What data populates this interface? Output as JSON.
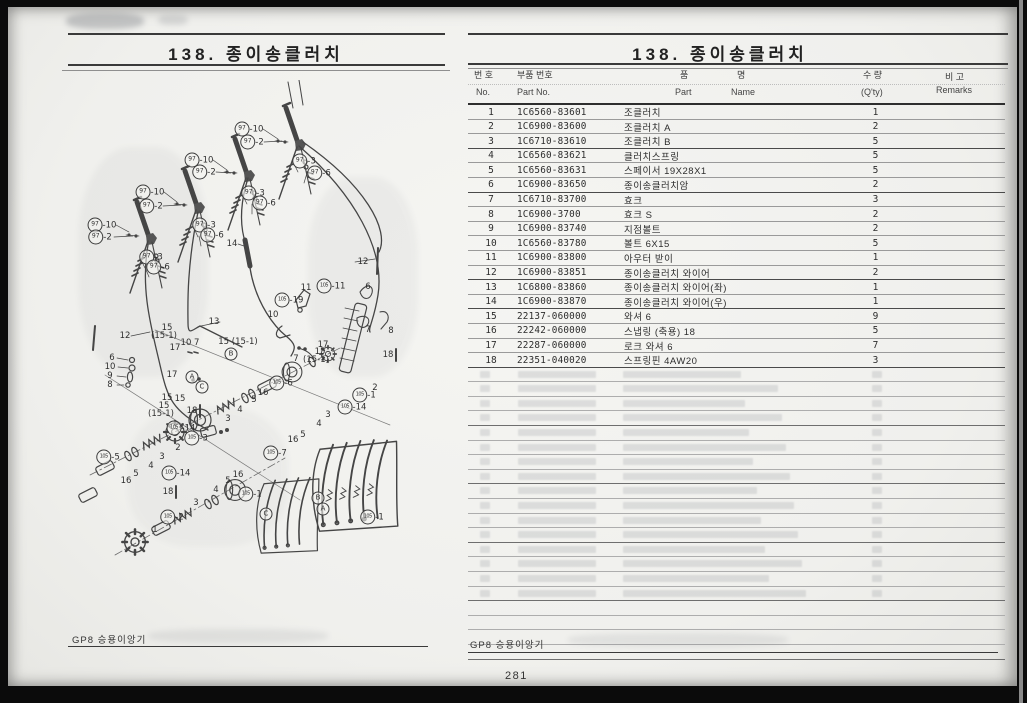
{
  "meta": {
    "ink_color": "#3f3f3f",
    "paper_color": "#f1f1ee",
    "frame_color": "#0b0b0b"
  },
  "page_number": "281",
  "left_page": {
    "title": "138.  종이송클러치",
    "footer": "GP8 승용이앙기"
  },
  "right_page": {
    "title": "138.  종이송클러치",
    "footer": "GP8 승용이앙기",
    "table": {
      "headers": {
        "no_ko": "번 호",
        "no_en": "No.",
        "part_ko": "부품 번호",
        "part_en": "Part  No.",
        "name_ko_1": "품",
        "name_ko_2": "명",
        "name_en_1": "Part",
        "name_en_2": "Name",
        "qty_ko": "수 량",
        "qty_en": "(Q'ty)",
        "remarks_ko": "비 고",
        "remarks_en": "Remarks"
      },
      "rows": [
        {
          "no": "1",
          "part": "1C6560-83601",
          "name": "조클러치",
          "qty": "1",
          "remarks": ""
        },
        {
          "no": "2",
          "part": "1C6900-83600",
          "name": "조클러치 A",
          "qty": "2",
          "remarks": ""
        },
        {
          "no": "3",
          "part": "1C6710-83610",
          "name": "조클러치 B",
          "qty": "5",
          "remarks": ""
        },
        {
          "no": "4",
          "part": "1C6560-83621",
          "name": "클러치스프링",
          "qty": "5",
          "remarks": ""
        },
        {
          "no": "5",
          "part": "1C6560-83631",
          "name": "스페이서 19X28X1",
          "qty": "5",
          "remarks": ""
        },
        {
          "no": "6",
          "part": "1C6900-83650",
          "name": "종이송클러치암",
          "qty": "2",
          "remarks": ""
        },
        {
          "no": "7",
          "part": "1C6710-83700",
          "name": "효크",
          "qty": "3",
          "remarks": ""
        },
        {
          "no": "8",
          "part": "1C6900-3700",
          "name": "효크 S",
          "qty": "2",
          "remarks": ""
        },
        {
          "no": "9",
          "part": "1C6900-83740",
          "name": "지점볼트",
          "qty": "2",
          "remarks": ""
        },
        {
          "no": "10",
          "part": "1C6560-83780",
          "name": "볼트 6X15",
          "qty": "5",
          "remarks": ""
        },
        {
          "no": "11",
          "part": "1C6900-83800",
          "name": "아우터 받이",
          "qty": "1",
          "remarks": ""
        },
        {
          "no": "12",
          "part": "1C6900-83851",
          "name": "종이송클러치 와이어",
          "qty": "2",
          "remarks": ""
        },
        {
          "no": "13",
          "part": "1C6800-83860",
          "name": "종이송클러치 와이어(좌)",
          "qty": "1",
          "remarks": ""
        },
        {
          "no": "14",
          "part": "1C6900-83870",
          "name": "종이송클러치 와이어(우)",
          "qty": "1",
          "remarks": ""
        },
        {
          "no": "15",
          "part": "22137-060000",
          "name": "와셔 6",
          "qty": "9",
          "remarks": ""
        },
        {
          "no": "16",
          "part": "22242-060000",
          "name": "스냅링 (축용) 18",
          "qty": "5",
          "remarks": ""
        },
        {
          "no": "17",
          "part": "22287-060000",
          "name": "로크 와셔 6",
          "qty": "7",
          "remarks": ""
        },
        {
          "no": "18",
          "part": "22351-040020",
          "name": "스프링핀 4AW20",
          "qty": "3",
          "remarks": ""
        }
      ],
      "heavy_after_rows": [
        3,
        6,
        12,
        14,
        18
      ],
      "empty_row_count": 20
    }
  },
  "diagram": {
    "callouts": [
      {
        "t": "97",
        "s": "-10",
        "x": 42,
        "y": 145
      },
      {
        "t": "97",
        "s": "-2",
        "x": 40,
        "y": 157
      },
      {
        "t": "97",
        "s": "-3",
        "x": 91,
        "y": 177
      },
      {
        "t": "97",
        "s": "-6",
        "x": 98,
        "y": 187
      },
      {
        "t": "97",
        "s": "-10",
        "x": 90,
        "y": 112
      },
      {
        "t": "97",
        "s": "-2",
        "x": 91,
        "y": 126
      },
      {
        "t": "97",
        "s": "-3",
        "x": 144,
        "y": 145
      },
      {
        "t": "97",
        "s": "-6",
        "x": 152,
        "y": 155
      },
      {
        "t": "97",
        "s": "-10",
        "x": 139,
        "y": 80
      },
      {
        "t": "97",
        "s": "-2",
        "x": 144,
        "y": 92
      },
      {
        "t": "97",
        "s": "-3",
        "x": 193,
        "y": 113
      },
      {
        "t": "97",
        "s": "-6",
        "x": 204,
        "y": 123
      },
      {
        "t": "97",
        "s": "-10",
        "x": 189,
        "y": 49
      },
      {
        "t": "97",
        "s": "-2",
        "x": 192,
        "y": 62
      },
      {
        "t": "97",
        "s": "-3",
        "x": 244,
        "y": 81
      },
      {
        "t": "97",
        "s": "-6",
        "x": 259,
        "y": 93
      },
      {
        "t": "p",
        "s": "14",
        "x": 172,
        "y": 164
      },
      {
        "t": "p",
        "s": "12",
        "x": 303,
        "y": 182
      },
      {
        "t": "p",
        "s": "13",
        "x": 154,
        "y": 242
      },
      {
        "t": "p",
        "s": "12",
        "x": 65,
        "y": 256
      },
      {
        "t": "p",
        "s": "15",
        "x": 107,
        "y": 248
      },
      {
        "t": "p",
        "s": "(15-1)",
        "x": 104,
        "y": 256
      },
      {
        "t": "p",
        "s": "6",
        "x": 52,
        "y": 278
      },
      {
        "t": "p",
        "s": "10",
        "x": 50,
        "y": 287
      },
      {
        "t": "p",
        "s": "9",
        "x": 50,
        "y": 296
      },
      {
        "t": "p",
        "s": "8",
        "x": 50,
        "y": 305
      },
      {
        "t": "p",
        "s": "17",
        "x": 115,
        "y": 268
      },
      {
        "t": "p",
        "s": "10 7",
        "x": 130,
        "y": 263
      },
      {
        "t": "p",
        "s": "15 (15-1)",
        "x": 178,
        "y": 262
      },
      {
        "t": "L",
        "s": "B",
        "x": 171,
        "y": 274
      },
      {
        "t": "p",
        "s": "17",
        "x": 112,
        "y": 295
      },
      {
        "t": "L",
        "s": "A",
        "x": 132,
        "y": 297
      },
      {
        "t": "L",
        "s": "C",
        "x": 142,
        "y": 307
      },
      {
        "t": "p",
        "s": "15",
        "x": 107,
        "y": 318
      },
      {
        "t": "p",
        "s": "15",
        "x": 120,
        "y": 319
      },
      {
        "t": "p",
        "s": "15",
        "x": 104,
        "y": 326
      },
      {
        "t": "p",
        "s": "(15-1)",
        "x": 101,
        "y": 334
      },
      {
        "t": "p",
        "s": "18",
        "x": 132,
        "y": 331
      },
      {
        "t": "p",
        "s": "2",
        "x": 118,
        "y": 368
      },
      {
        "t": "p",
        "s": "3",
        "x": 102,
        "y": 377
      },
      {
        "t": "p",
        "s": "4",
        "x": 91,
        "y": 386
      },
      {
        "t": "p",
        "s": "5",
        "x": 76,
        "y": 394
      },
      {
        "t": "p",
        "s": "16",
        "x": 66,
        "y": 401
      },
      {
        "t": "105",
        "s": "-5",
        "x": 48,
        "y": 377
      },
      {
        "t": "105",
        "s": "-14",
        "x": 121,
        "y": 348
      },
      {
        "t": "105",
        "s": "-3",
        "x": 136,
        "y": 358
      },
      {
        "t": "p",
        "s": "18",
        "x": 108,
        "y": 412
      },
      {
        "t": "p",
        "s": "1",
        "x": 95,
        "y": 450
      },
      {
        "t": "105",
        "s": "-2",
        "x": 112,
        "y": 437
      },
      {
        "t": "105",
        "s": "-14",
        "x": 116,
        "y": 393
      },
      {
        "t": "p",
        "s": "3",
        "x": 136,
        "y": 423
      },
      {
        "t": "p",
        "s": "4",
        "x": 156,
        "y": 410
      },
      {
        "t": "p",
        "s": "5",
        "x": 168,
        "y": 401
      },
      {
        "t": "p",
        "s": "16",
        "x": 178,
        "y": 395
      },
      {
        "t": "p",
        "s": "16",
        "x": 203,
        "y": 313
      },
      {
        "t": "p",
        "s": "5",
        "x": 194,
        "y": 320
      },
      {
        "t": "p",
        "s": "4",
        "x": 180,
        "y": 330
      },
      {
        "t": "p",
        "s": "3",
        "x": 168,
        "y": 339
      },
      {
        "t": "105",
        "s": "-6",
        "x": 221,
        "y": 303
      },
      {
        "t": "p",
        "s": "16",
        "x": 233,
        "y": 360
      },
      {
        "t": "p",
        "s": "5",
        "x": 243,
        "y": 355
      },
      {
        "t": "p",
        "s": "4",
        "x": 259,
        "y": 344
      },
      {
        "t": "p",
        "s": "3",
        "x": 268,
        "y": 335
      },
      {
        "t": "105",
        "s": "-7",
        "x": 215,
        "y": 373
      },
      {
        "t": "105",
        "s": "-14",
        "x": 292,
        "y": 327
      },
      {
        "t": "105",
        "s": "-1",
        "x": 304,
        "y": 315
      },
      {
        "t": "p",
        "s": "2",
        "x": 315,
        "y": 308
      },
      {
        "t": "p",
        "s": "18",
        "x": 328,
        "y": 275
      },
      {
        "t": "p",
        "s": "11",
        "x": 246,
        "y": 208
      },
      {
        "t": "105",
        "s": "-11",
        "x": 271,
        "y": 206
      },
      {
        "t": "105",
        "s": "-19",
        "x": 229,
        "y": 220
      },
      {
        "t": "p",
        "s": "10",
        "x": 213,
        "y": 235
      },
      {
        "t": "p",
        "s": "6",
        "x": 308,
        "y": 207
      },
      {
        "t": "p",
        "s": "7",
        "x": 308,
        "y": 250
      },
      {
        "t": "p",
        "s": "8",
        "x": 331,
        "y": 251
      },
      {
        "t": "p",
        "s": "17",
        "x": 263,
        "y": 265
      },
      {
        "t": "p",
        "s": "15",
        "x": 260,
        "y": 272
      },
      {
        "t": "p",
        "s": "(15-1)",
        "x": 256,
        "y": 280
      },
      {
        "t": "p",
        "s": "7",
        "x": 236,
        "y": 279
      },
      {
        "t": "105",
        "s": "-1",
        "x": 190,
        "y": 414
      },
      {
        "t": "L",
        "s": "C",
        "x": 206,
        "y": 434
      },
      {
        "t": "L",
        "s": "B",
        "x": 258,
        "y": 418
      },
      {
        "t": "L",
        "s": "A",
        "x": 263,
        "y": 429
      },
      {
        "t": "105",
        "s": "-1",
        "x": 312,
        "y": 437
      }
    ]
  }
}
